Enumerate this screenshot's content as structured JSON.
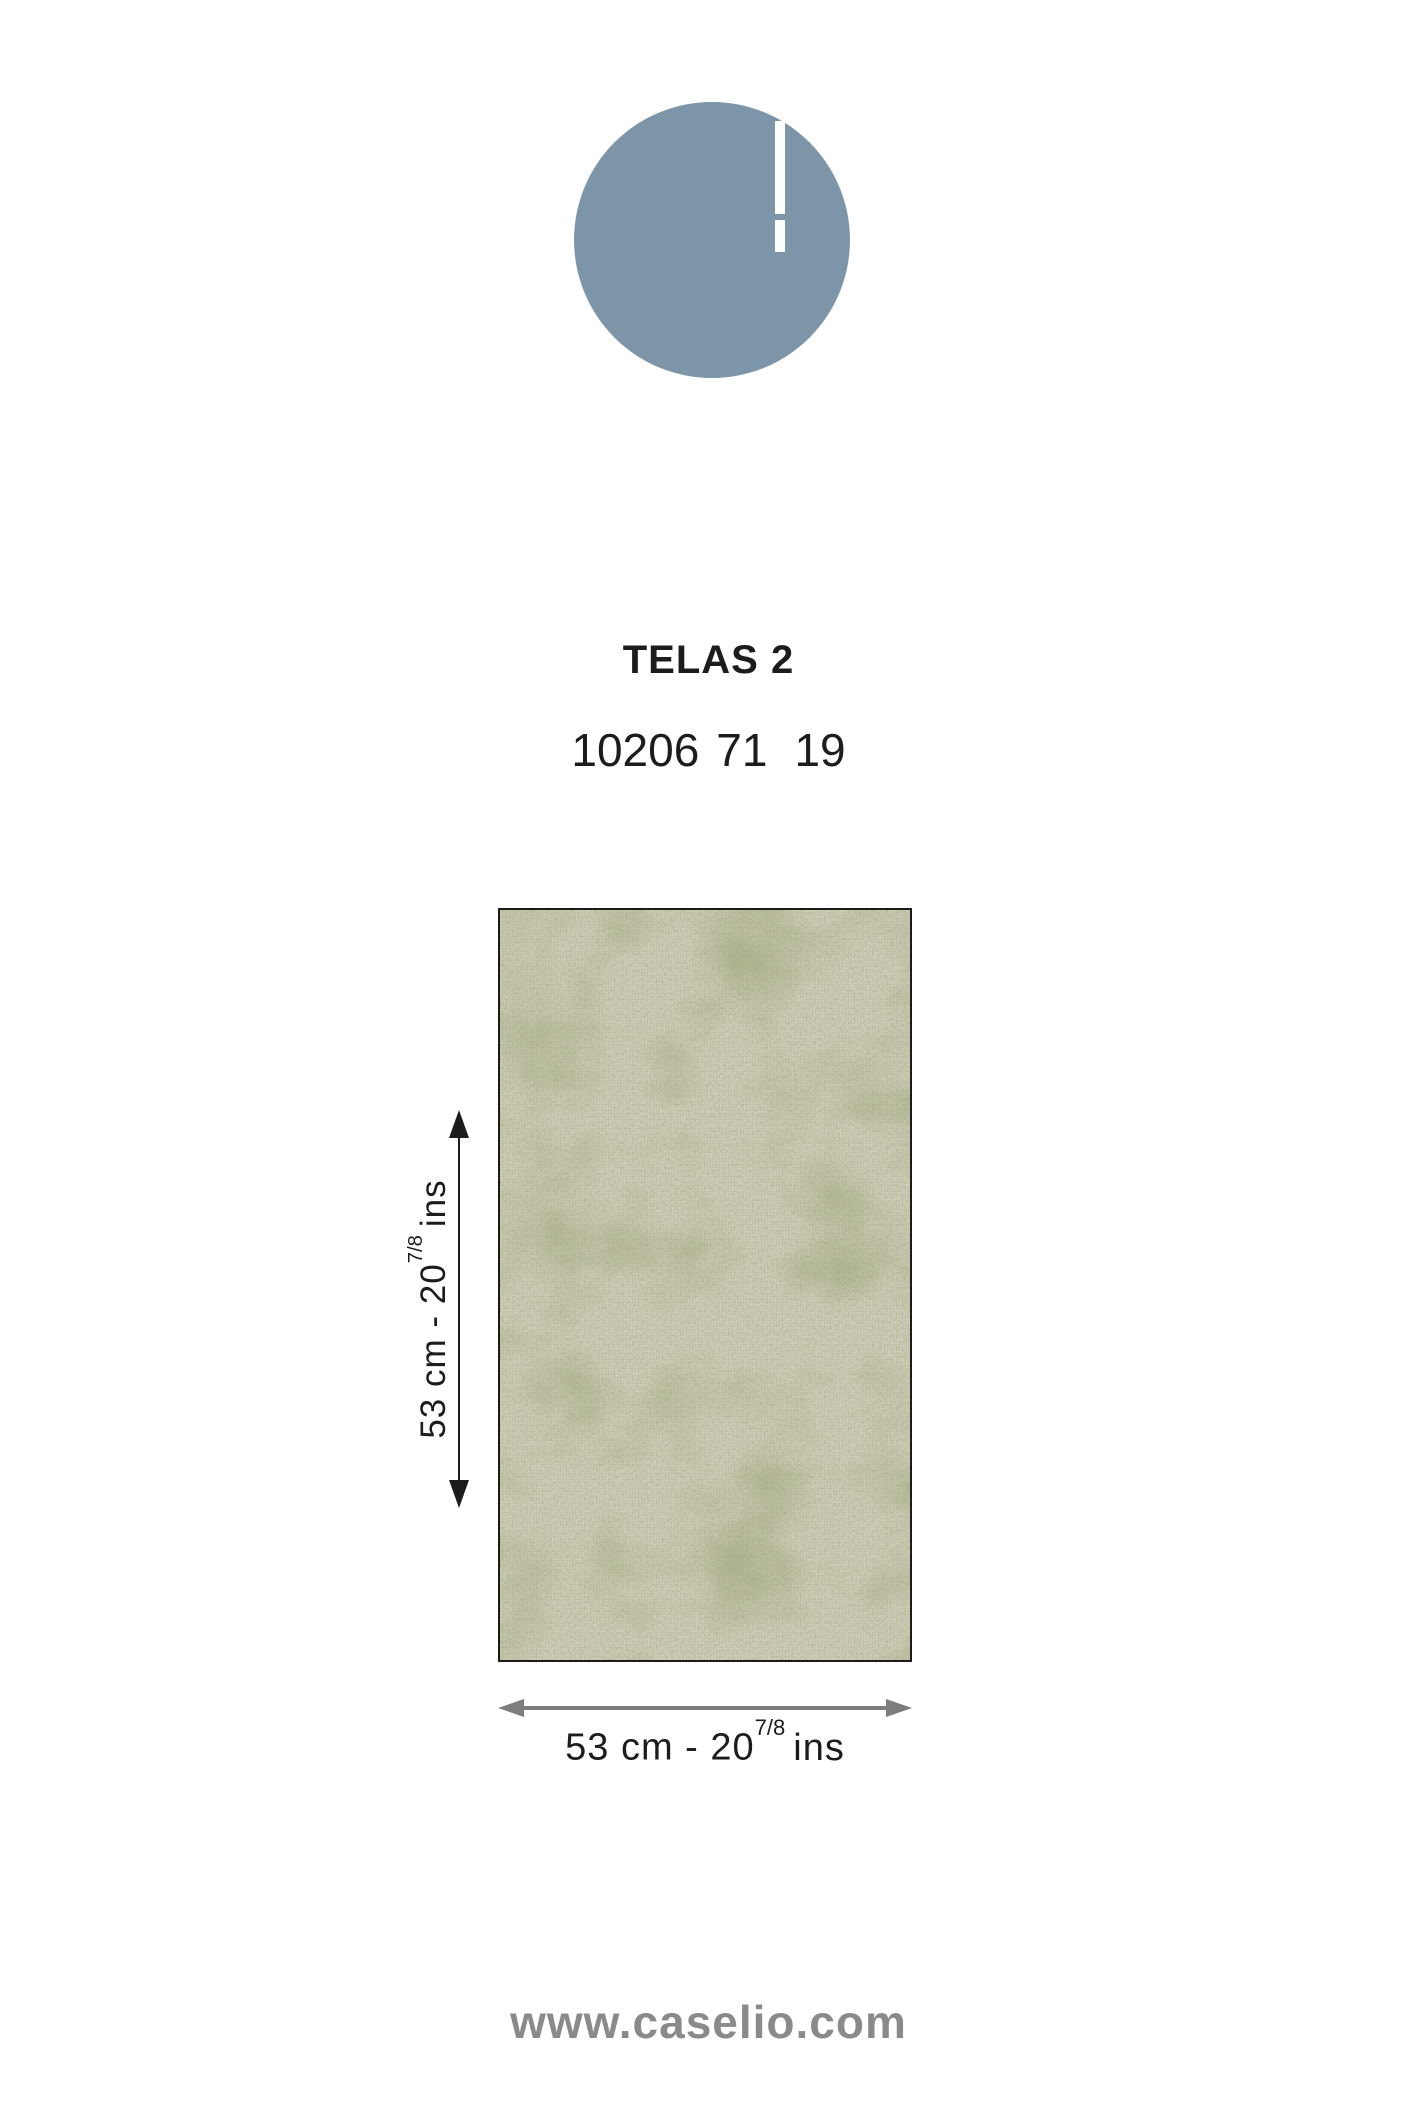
{
  "logo": {
    "brand": "CASELIO",
    "word_left": "CASEL",
    "word_right": "O",
    "circle_color": "#7c95a8"
  },
  "product": {
    "collection": "TELAS 2",
    "reference": "10206 71 19",
    "reference_parts": [
      "10206",
      "71",
      "19"
    ]
  },
  "swatch": {
    "base_color": "#cfceb8",
    "mottle_color": "#a6ab85",
    "thread_color": "#9aa078",
    "border_color": "#1b1b1b"
  },
  "dimensions": {
    "height_label": {
      "prefix": "53 cm - 20",
      "fraction": "7/8",
      "unit": "ins"
    },
    "width_label": {
      "prefix": "53 cm - 20",
      "fraction": "7/8",
      "unit": "ins"
    },
    "vertical_arrow_color": "#1c1c1c",
    "horizontal_arrow_color": "#7d7d7d"
  },
  "footer": {
    "url": "www.caselio.com",
    "color": "#8a8a8a"
  }
}
